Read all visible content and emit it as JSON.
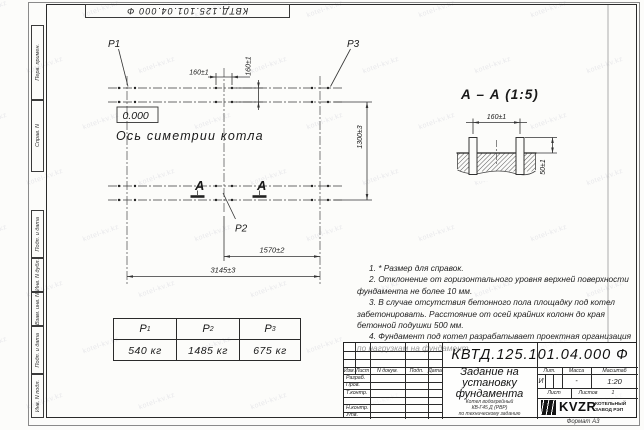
{
  "watermark": {
    "text": "kotel-kv.kz"
  },
  "margin_boxes": [
    "Перв. примен.",
    "Справ. N",
    "Подп. и дата",
    "Инв. N дубл.",
    "Взам. инв. N",
    "Подп. и дата",
    "Инв. N подл."
  ],
  "top_doc_number": "КВТД.125.101.04.000 Ф",
  "plan": {
    "label_p1": "P1",
    "label_p2": "P2",
    "label_p3": "P3",
    "elevation": "0.000",
    "axis_caption": "Ось симетрии котла",
    "section_mark": "А",
    "dims": {
      "bolt_h": "160±1",
      "bolt_v": "160±1",
      "height": "1300±3",
      "half": "1570±2",
      "total": "3145±3"
    }
  },
  "section_view": {
    "title": "А – А (1:5)",
    "dims": {
      "bolt": "160±1",
      "protrusion": "50±1"
    }
  },
  "notes": [
    "1. * Размер для справок.",
    "2. Отклонение от горизонтального уровня верхней поверхности фундамента не более 10 мм.",
    "3. В случае отсутствия бетонного пола площадку под котел забетонировать. Расстояние от осей крайних колонн до края бетонной подушки 500 мм.",
    "4. Фундамент под котел разрабатывает проектная организация по нагрузкам на фундамент."
  ],
  "load_table": {
    "columns": [
      {
        "symbol": "P",
        "sub": "1",
        "value": "540 кг"
      },
      {
        "symbol": "P",
        "sub": "2",
        "value": "1485 кг"
      },
      {
        "symbol": "P",
        "sub": "3",
        "value": "675 кг"
      }
    ]
  },
  "title_block": {
    "doc_number": "КВТД.125.101.04.000 Ф",
    "title": "Задание на установку фундамента",
    "subtitle": [
      "Котел водогрейный",
      "КВ-Г45 Д (РВР)",
      "по техническому заданию"
    ],
    "rev_header": [
      "Изм.",
      "Лист",
      "N докум.",
      "Подп.",
      "Дата"
    ],
    "role_rows": [
      "Разраб.",
      "Пров.",
      "Т.контр.",
      "",
      "Н.контр.",
      "Утв."
    ],
    "lit": {
      "label": "Лит.",
      "value": "И"
    },
    "mass": {
      "label": "Масса",
      "value": "-"
    },
    "scale": {
      "label": "Масштаб",
      "value": "1:20"
    },
    "sheet": {
      "label": "Лист",
      "sheets_label": "Листов",
      "sheets_value": "1"
    },
    "company": {
      "logo": "KVZR",
      "name_line1": "КОТЕЛЬНЫЙ",
      "name_line2": "ЗАВОД РЭП"
    },
    "format": "Формат А3"
  }
}
